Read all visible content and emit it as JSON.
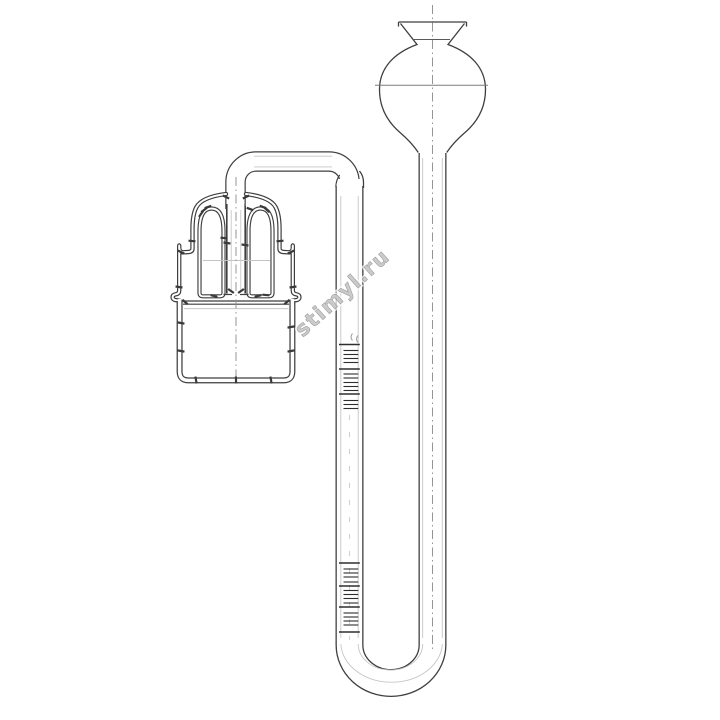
{
  "canvas": {
    "width": 720,
    "height": 720,
    "background": "#ffffff"
  },
  "palette": {
    "line": "#3f3f3f",
    "bore_white": "#ffffff",
    "faint": "#c6c6c6",
    "centerline": "#8a8a8a",
    "scale": "#2e2e2e",
    "hatch": "#3a3a3a",
    "watermark": "#c2c2c2"
  },
  "watermark": {
    "text": "stimyl.ru",
    "rotation_deg": -42,
    "x": 347,
    "y": 298,
    "font_size": 21
  },
  "scales": {
    "tick_geometry": {
      "major_x1": 339,
      "major_x2": 359.8,
      "minor_x1": 343.5,
      "minor_x2": 358.3
    },
    "upper": {
      "major_y": [
        344.5,
        369,
        394
      ],
      "minor_y": [
        350.5,
        354.5,
        358.5,
        362.5,
        374,
        378,
        382.5,
        386.5,
        390.5,
        400.5,
        404.5,
        408.5
      ]
    },
    "lower": {
      "major_y": [
        563,
        586,
        607,
        632
      ],
      "minor_y": [
        569,
        573,
        577,
        582,
        590.5,
        594.5,
        598.5,
        603,
        613,
        617,
        621,
        625
      ]
    }
  },
  "hatch_marks": [
    [
      201,
      214,
      -55
    ],
    [
      204,
      210,
      -38
    ],
    [
      208,
      207,
      -20
    ],
    [
      250,
      209,
      20
    ],
    [
      263,
      207,
      20
    ],
    [
      267,
      210,
      42
    ],
    [
      192,
      241,
      5
    ],
    [
      280,
      241,
      -5
    ],
    [
      181,
      252,
      25
    ],
    [
      291,
      252,
      -25
    ],
    [
      179,
      287,
      8
    ],
    [
      293,
      287,
      -8
    ],
    [
      227,
      243,
      8
    ],
    [
      245,
      245,
      8
    ],
    [
      231,
      291,
      35
    ],
    [
      241,
      291,
      -35
    ],
    [
      214,
      296,
      15
    ],
    [
      258,
      296,
      -15
    ],
    [
      266,
      295,
      5
    ],
    [
      224,
      238,
      5
    ],
    [
      185,
      302,
      40
    ],
    [
      287,
      302,
      -40
    ],
    [
      181,
      323,
      10
    ],
    [
      181,
      351,
      10
    ],
    [
      291,
      327,
      -10
    ],
    [
      291,
      351,
      -10
    ],
    [
      196,
      380,
      80
    ],
    [
      236,
      380,
      88
    ],
    [
      271,
      380,
      80
    ],
    [
      226,
      197,
      25
    ],
    [
      246,
      197,
      -25
    ]
  ]
}
